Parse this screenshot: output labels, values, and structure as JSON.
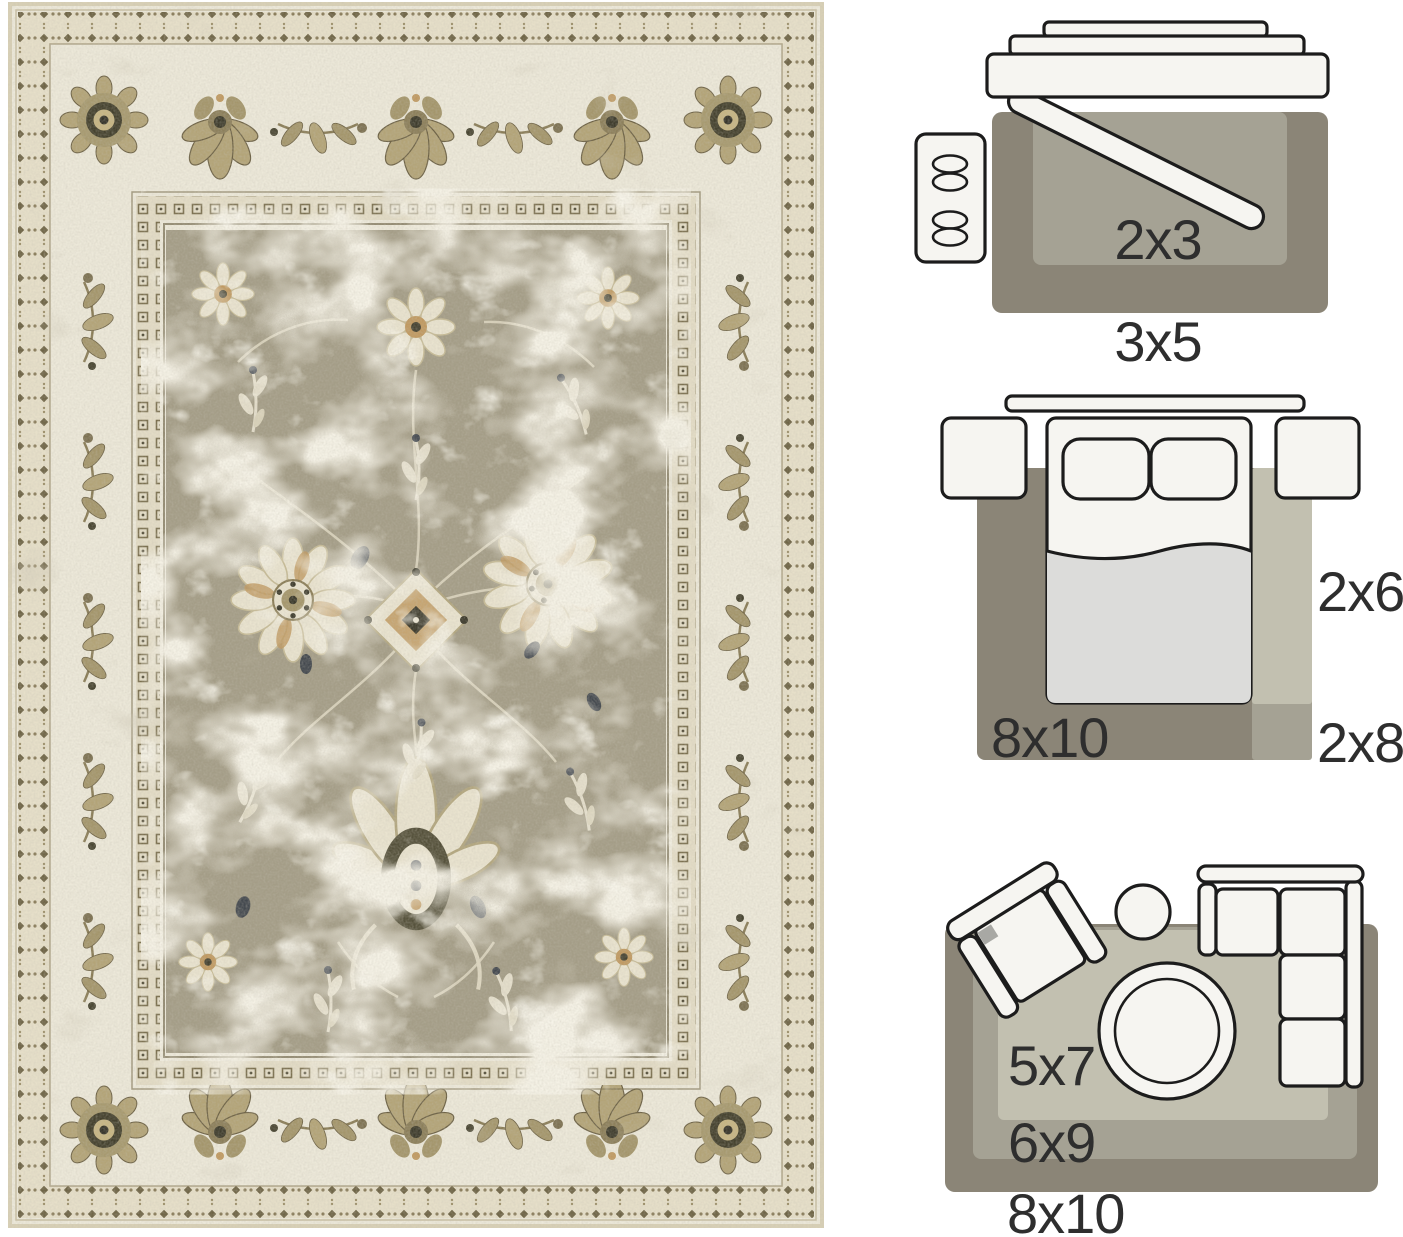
{
  "window": {
    "width": 1403,
    "height": 1237,
    "background": "#ffffff"
  },
  "rug_photo": {
    "description": "Distressed vintage Persian-style area rug photo: ivory floral border, taupe field with cream floral medallions, navy and tan accents",
    "palette": {
      "ivory": "#ece8d9",
      "field_taupe": "#a49d87",
      "motif_cream": "#e9e3cf",
      "olive": "#7d7253",
      "tan": "#c09a62",
      "charcoal": "#3c3a2c",
      "navy": "#333a45"
    }
  },
  "size_guide": {
    "text_color": "#2e2e2e",
    "rug_dark": "#8b8577",
    "rug_mid": "#a5a294",
    "rug_light": "#c2c0b0",
    "furniture_fill": "#f6f5f1",
    "furniture_stroke": "#1c1c1c",
    "blanket_fill": "#dcdcda",
    "chair_pad_gray": "#a8a8a4",
    "entryway": {
      "small_rug": "2x3",
      "large_rug": "3x5"
    },
    "bedroom": {
      "area_rug": "8x10",
      "runner_short": "2x6",
      "runner_long": "2x8"
    },
    "living_room": {
      "small_rug": "5x7",
      "medium_rug": "6x9",
      "large_rug": "8x10"
    }
  }
}
